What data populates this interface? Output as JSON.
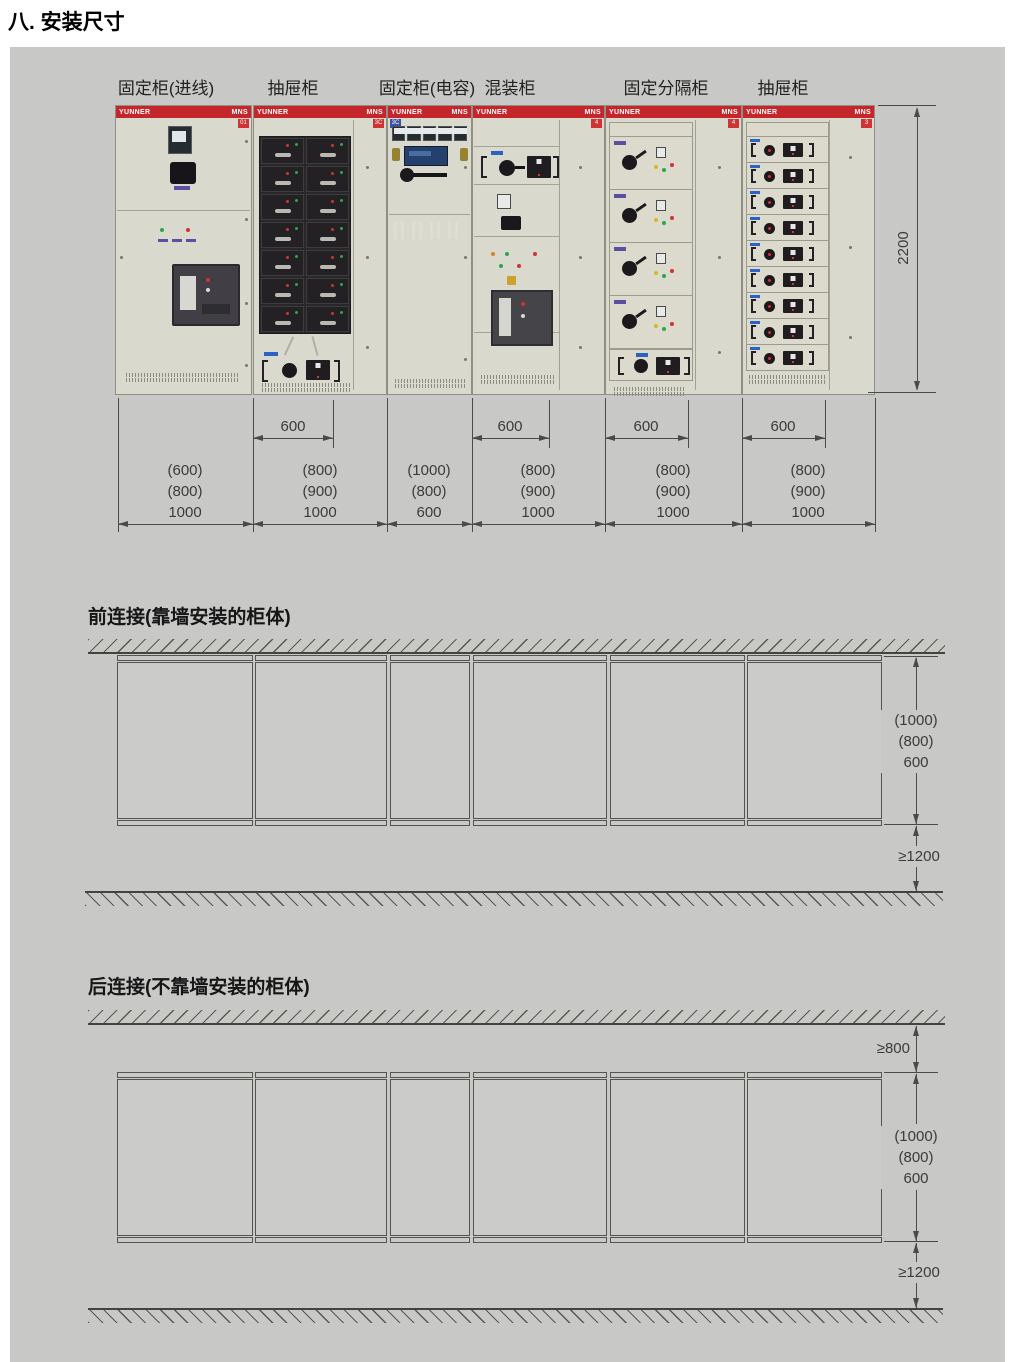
{
  "page_title": "八. 安装尺寸",
  "colors": {
    "header_red": "#c4262c",
    "badge_blue": "#3b53a5",
    "cabinet_beige": "#dad9cd",
    "panel_gray": "#c8c8c6"
  },
  "brand": {
    "left": "YUNNER",
    "right": "MNS"
  },
  "photo": {
    "height_dim": "2200",
    "cabinets": [
      {
        "label": "固定柜(进线)",
        "badge": "01",
        "top_dim": "",
        "width_dims": [
          "(600)",
          "(800)",
          "1000"
        ]
      },
      {
        "label": "抽屉柜",
        "badge": "3C",
        "top_dim": "600",
        "width_dims": [
          "(800)",
          "(900)",
          "1000"
        ]
      },
      {
        "label": "固定柜(电容)",
        "badge": "3C",
        "top_dim": "",
        "width_dims": [
          "(1000)",
          "(800)",
          "600"
        ]
      },
      {
        "label": "混装柜",
        "badge": "4",
        "top_dim": "600",
        "width_dims": [
          "(800)",
          "(900)",
          "1000"
        ]
      },
      {
        "label": "固定分隔柜",
        "badge": "4",
        "top_dim": "600",
        "width_dims": [
          "(800)",
          "(900)",
          "1000"
        ]
      },
      {
        "label": "抽屉柜",
        "badge": "3",
        "top_dim": "600",
        "width_dims": [
          "(800)",
          "(900)",
          "1000"
        ]
      }
    ]
  },
  "front_connection": {
    "title": "前连接(靠墙安装的柜体)",
    "depth_dims": [
      "(1000)",
      "(800)",
      "600"
    ],
    "aisle_dim": "≥1200"
  },
  "rear_connection": {
    "title": "后连接(不靠墙安装的柜体)",
    "wall_gap_dim": "≥800",
    "depth_dims": [
      "(1000)",
      "(800)",
      "600"
    ],
    "aisle_dim": "≥1200"
  }
}
